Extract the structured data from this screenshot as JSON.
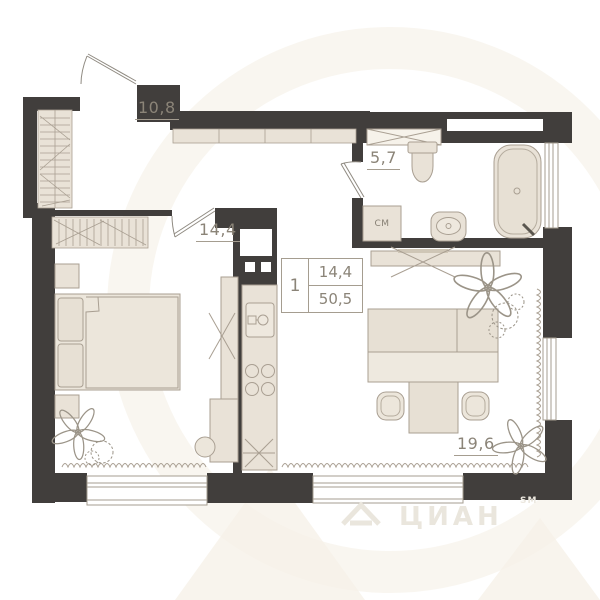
{
  "plan": {
    "rooms": [
      {
        "id": "hallway-kitchen",
        "area_label": "10,8"
      },
      {
        "id": "bedroom",
        "area_label": "14,4"
      },
      {
        "id": "bathroom",
        "area_label": "5,7"
      },
      {
        "id": "living-room",
        "area_label": "19,6"
      }
    ],
    "summary": {
      "rooms_count": "1",
      "living_area": "14,4",
      "total_area": "50,5"
    },
    "appliances": {
      "washing_machine_label": "СМ"
    },
    "watermark": {
      "brand": "ЦИАН",
      "trademark": "SM"
    },
    "colors": {
      "wall": "#413e3c",
      "furniture_fill": "#eae3d8",
      "furniture_stroke": "#a99f92",
      "label_text": "#8b8478",
      "watermark": "#f5f0e6"
    }
  }
}
